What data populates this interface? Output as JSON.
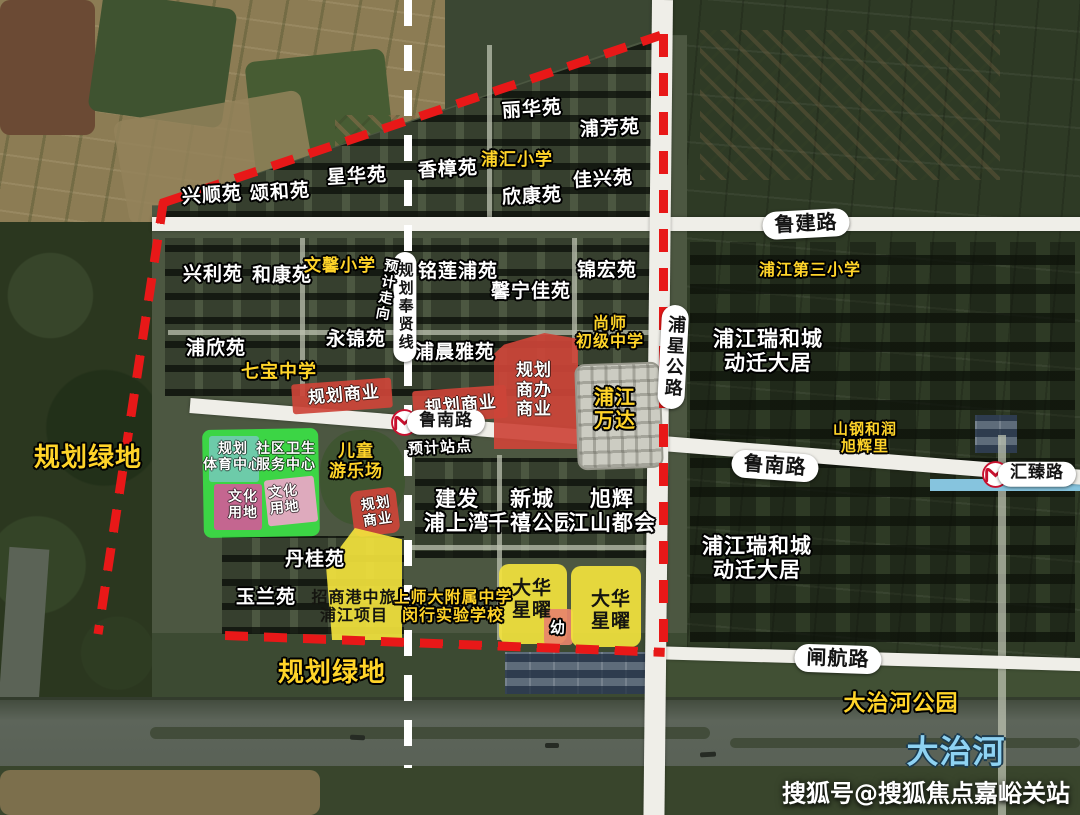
{
  "map": {
    "watermark": "搜狐号@搜狐焦点嘉峪关站",
    "colors": {
      "boundary": "#e81818",
      "planned-line": "#ffffff",
      "road": "#efeee8",
      "commercial": "#cd4438",
      "project-yellow": "#f2e23d",
      "green-zone": "#3bdf45",
      "sports-teal": "#72cab2",
      "culture-pink": "#d05c97",
      "culture-pink-light": "#eda6c8",
      "kindergarten": "#e8846b",
      "school-text": "#ffd429",
      "river-text": "#8ed2f2"
    },
    "labels": [
      {
        "id": "compound-lihuayuan",
        "text": "丽华苑",
        "x": 532,
        "y": 110,
        "style": "w",
        "size": 19,
        "rot": -4
      },
      {
        "id": "compound-pufangyuan",
        "text": "浦芳苑",
        "x": 610,
        "y": 129,
        "style": "w",
        "size": 19,
        "rot": -3
      },
      {
        "id": "compound-xinghuayuan",
        "text": "星华苑",
        "x": 357,
        "y": 177,
        "style": "w",
        "size": 19,
        "rot": -3
      },
      {
        "id": "compound-xiangzhangyuan",
        "text": "香樟苑",
        "x": 448,
        "y": 170,
        "style": "w",
        "size": 19,
        "rot": -3
      },
      {
        "id": "compound-xinkangyuan",
        "text": "欣康苑",
        "x": 532,
        "y": 197,
        "style": "w",
        "size": 19,
        "rot": -3
      },
      {
        "id": "compound-jiaxingyuan",
        "text": "佳兴苑",
        "x": 603,
        "y": 180,
        "style": "w",
        "size": 19,
        "rot": -3
      },
      {
        "id": "compound-xingshunyuan",
        "text": "兴顺苑",
        "x": 212,
        "y": 196,
        "style": "w",
        "size": 19,
        "rot": -4
      },
      {
        "id": "compound-songheyuan",
        "text": "颂和苑",
        "x": 280,
        "y": 193,
        "style": "w",
        "size": 19,
        "rot": -4
      },
      {
        "id": "compound-xingliyuan",
        "text": "兴利苑",
        "x": 213,
        "y": 275,
        "style": "w",
        "size": 19
      },
      {
        "id": "compound-hekangyuan",
        "text": "和康苑",
        "x": 282,
        "y": 276,
        "style": "w",
        "size": 19
      },
      {
        "id": "compound-minglianpuyuan",
        "text": "铭莲浦苑",
        "x": 458,
        "y": 272,
        "style": "w",
        "size": 19
      },
      {
        "id": "compound-xinningjiayuan",
        "text": "馨宁佳苑",
        "x": 531,
        "y": 292,
        "style": "w",
        "size": 19
      },
      {
        "id": "compound-jinhongyuan",
        "text": "锦宏苑",
        "x": 607,
        "y": 271,
        "style": "w",
        "size": 19
      },
      {
        "id": "compound-puxinyuan",
        "text": "浦欣苑",
        "x": 216,
        "y": 349,
        "style": "w",
        "size": 19
      },
      {
        "id": "compound-yongjinyuan",
        "text": "永锦苑",
        "x": 356,
        "y": 340,
        "style": "w",
        "size": 19
      },
      {
        "id": "compound-puchenyayuan",
        "text": "浦晨雅苑",
        "x": 455,
        "y": 353,
        "style": "w",
        "size": 19
      },
      {
        "id": "compound-danguiyuan",
        "text": "丹桂苑",
        "x": 315,
        "y": 560,
        "style": "w",
        "size": 19
      },
      {
        "id": "compound-yulanyuan",
        "text": "玉兰苑",
        "x": 266,
        "y": 598,
        "style": "w",
        "size": 19
      },
      {
        "id": "school-puhui-primary",
        "text": "浦汇小学",
        "x": 517,
        "y": 161,
        "style": "y",
        "size": 17
      },
      {
        "id": "school-wenxin-primary",
        "text": "文馨小学",
        "x": 340,
        "y": 267,
        "style": "y",
        "size": 17
      },
      {
        "id": "school-qibao-middle",
        "text": "七宝中学",
        "x": 279,
        "y": 373,
        "style": "y",
        "size": 18
      },
      {
        "id": "school-shangshi-middle",
        "text": "尚师\n初级中学",
        "x": 610,
        "y": 333,
        "style": "y",
        "size": 16
      },
      {
        "id": "school-pujiang-third-primary",
        "text": "浦江第三小学",
        "x": 810,
        "y": 270,
        "style": "y",
        "size": 16
      },
      {
        "id": "school-shishida-affiliated",
        "text": "上师大附属中学\n闵行实验学校",
        "x": 453,
        "y": 607,
        "style": "y",
        "size": 16
      },
      {
        "id": "poi-pujiang-wanda",
        "text": "浦江\n万达",
        "x": 615,
        "y": 409,
        "style": "y",
        "size": 20
      },
      {
        "id": "poi-shangang-herun-xuhuili",
        "text": "山钢和润\n旭辉里",
        "x": 865,
        "y": 438,
        "style": "y",
        "size": 15
      },
      {
        "id": "poi-children-playground",
        "text": "儿童\n游乐场",
        "x": 356,
        "y": 462,
        "style": "y",
        "size": 17
      },
      {
        "id": "zone-green-west-label",
        "text": "规划绿地",
        "x": 88,
        "y": 459,
        "style": "y",
        "size": 26
      },
      {
        "id": "zone-green-south-label",
        "text": "规划绿地",
        "x": 332,
        "y": 674,
        "style": "y",
        "size": 26
      },
      {
        "id": "poi-dazhihe-park",
        "text": "大治河公园",
        "x": 901,
        "y": 704,
        "style": "y",
        "size": 22
      },
      {
        "id": "district-ruihecheng-north",
        "text": "浦江瑞和城\n动迁大居",
        "x": 768,
        "y": 351,
        "style": "w",
        "size": 21
      },
      {
        "id": "district-ruihecheng-south",
        "text": "浦江瑞和城\n动迁大居",
        "x": 757,
        "y": 558,
        "style": "w",
        "size": 21
      },
      {
        "id": "project-jianfa-pushangwan",
        "text": "建发\n浦上湾",
        "x": 457,
        "y": 511,
        "style": "w",
        "size": 21
      },
      {
        "id": "project-xincheng-qianxi-park",
        "text": "新城\n千禧公园",
        "x": 532,
        "y": 511,
        "style": "w",
        "size": 21
      },
      {
        "id": "project-xuhui-jiangshan-duhui",
        "text": "旭辉\n江山都会",
        "x": 612,
        "y": 511,
        "style": "w",
        "size": 21
      },
      {
        "id": "poi-planned-station",
        "text": "预计站点",
        "x": 440,
        "y": 448,
        "style": "w",
        "size": 15,
        "rot": -3
      },
      {
        "id": "zone-kindergarten-label",
        "text": "幼",
        "x": 558,
        "y": 628,
        "style": "w",
        "size": 15
      },
      {
        "id": "project-zhaoshang-gangzhonglv",
        "text": "招商港中旅\n浦江项目",
        "x": 354,
        "y": 607,
        "style": "k",
        "size": 16
      },
      {
        "id": "project-dahua-xingyao-west",
        "text": "大华\n星曜",
        "x": 532,
        "y": 600,
        "style": "k",
        "size": 19
      },
      {
        "id": "project-dahua-xingyao-east",
        "text": "大华\n星曜",
        "x": 611,
        "y": 611,
        "style": "k",
        "size": 19
      },
      {
        "id": "zone-planned-commercial-west",
        "text": "规划商业",
        "x": 344,
        "y": 396,
        "style": "zw",
        "size": 17,
        "rot": -5
      },
      {
        "id": "zone-planned-commercial-mid",
        "text": "规划商业",
        "x": 461,
        "y": 406,
        "style": "zw",
        "size": 17,
        "rot": -5
      },
      {
        "id": "zone-planned-commercial-office",
        "text": "规划\n商办\n商业",
        "x": 534,
        "y": 391,
        "style": "zw",
        "size": 17
      },
      {
        "id": "zone-sports-center-label",
        "text": "规划\n体育中心",
        "x": 233,
        "y": 457,
        "style": "zw",
        "size": 14
      },
      {
        "id": "zone-community-health-label",
        "text": "社区卫生\n服务中心",
        "x": 286,
        "y": 457,
        "style": "zw",
        "size": 14
      },
      {
        "id": "zone-culture-west-label",
        "text": "文化\n用地",
        "x": 243,
        "y": 505,
        "style": "zw",
        "size": 14
      },
      {
        "id": "zone-culture-east-label",
        "text": "文化\n用地",
        "x": 284,
        "y": 500,
        "style": "zw",
        "size": 14,
        "rot": -6
      },
      {
        "id": "zone-planned-commercial-small",
        "text": "规划\n商业",
        "x": 377,
        "y": 512,
        "style": "zw",
        "size": 14,
        "rot": -8
      },
      {
        "id": "road-lujian-label",
        "text": "鲁建路",
        "x": 806,
        "y": 224,
        "style": "cap",
        "size": 20,
        "rot": -3
      },
      {
        "id": "road-lunan-west-label",
        "text": "鲁南路",
        "x": 446,
        "y": 422,
        "style": "cap",
        "size": 17
      },
      {
        "id": "road-lunan-east-label",
        "text": "鲁南路",
        "x": 775,
        "y": 466,
        "style": "cap",
        "size": 20,
        "rot": 4
      },
      {
        "id": "road-huizhen-label",
        "text": "汇臻路",
        "x": 1037,
        "y": 474,
        "style": "cap",
        "size": 17
      },
      {
        "id": "road-zhahang-label",
        "text": "闸航路",
        "x": 838,
        "y": 659,
        "style": "cap",
        "size": 20,
        "rot": 2
      },
      {
        "id": "road-puxing-highway-label",
        "text": "浦星公路",
        "x": 673,
        "y": 357,
        "style": "capv",
        "size": 18,
        "rot": 3
      },
      {
        "id": "line-planned-fengxian-label",
        "text": "规划奉贤线",
        "x": 405,
        "y": 307,
        "style": "capv",
        "size": 15
      },
      {
        "id": "note-expected-direction",
        "text": "预计走向",
        "x": 386,
        "y": 290,
        "style": "wv",
        "size": 14,
        "rot": 10
      },
      {
        "id": "river-dazhihe-label",
        "text": "大治河",
        "x": 956,
        "y": 752,
        "style": "blue",
        "size": 32
      }
    ]
  }
}
